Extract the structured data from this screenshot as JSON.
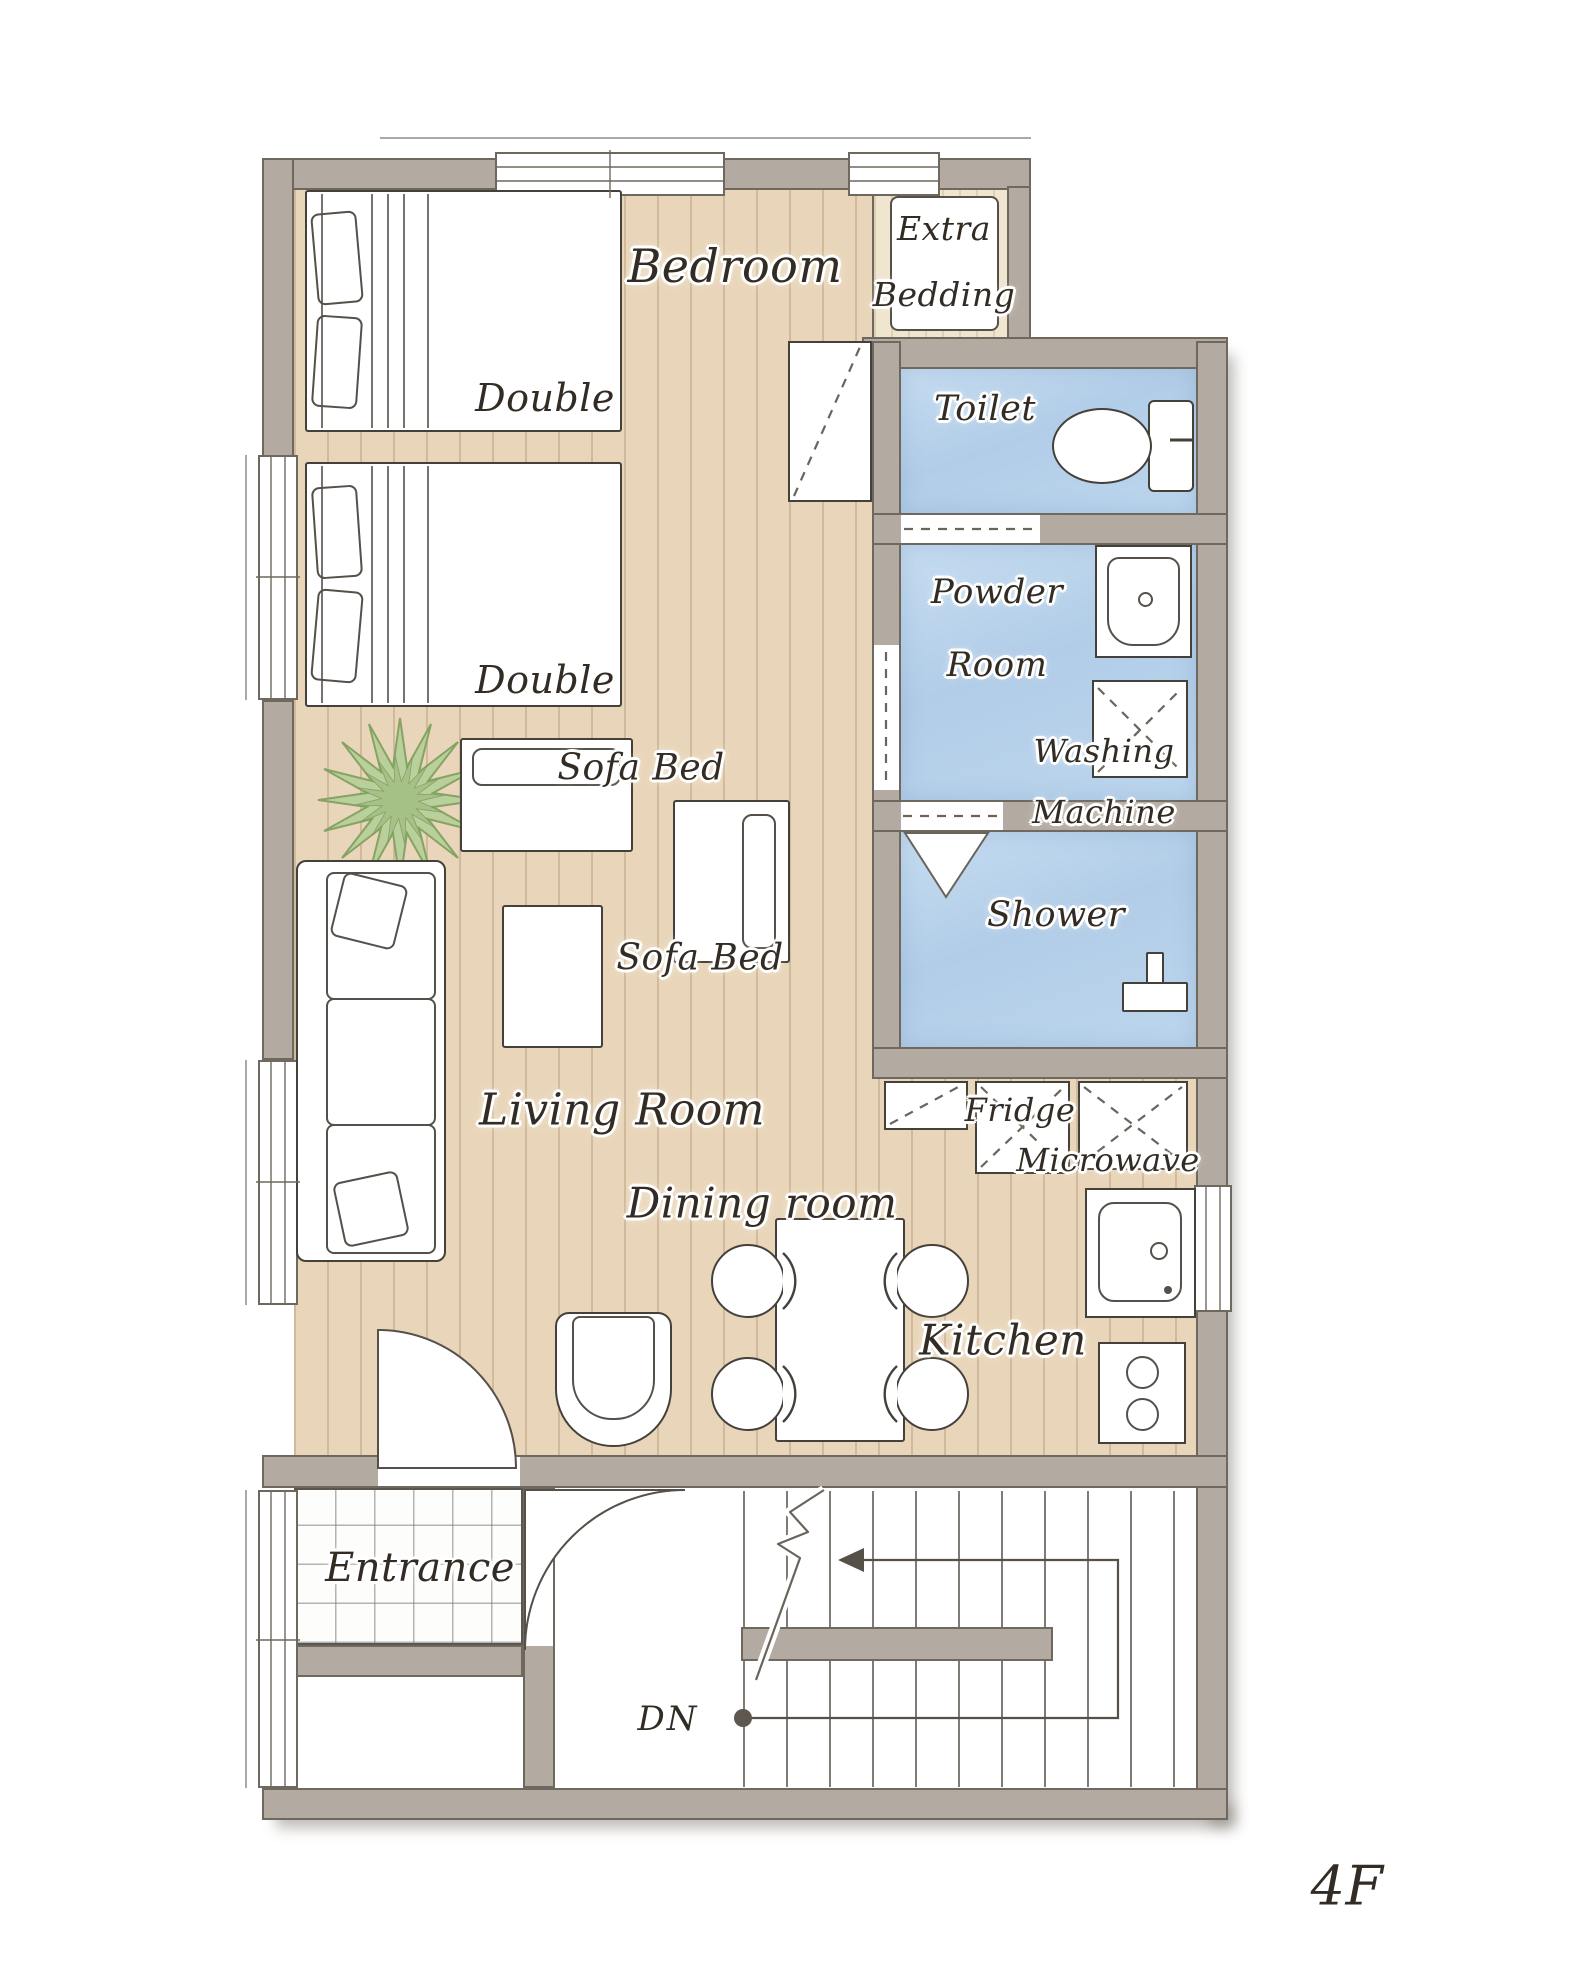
{
  "floor_indicator": "4F",
  "labels": {
    "bedroom": "Bedroom",
    "extra_bedding": [
      "Extra",
      "Bedding"
    ],
    "double_top": "Double",
    "double_bottom": "Double",
    "toilet": "Toilet",
    "powder_room": [
      "Powder",
      "Room"
    ],
    "washing_machine": [
      "Washing",
      "Machine"
    ],
    "shower": "Shower",
    "sofa_bed_top": "Sofa Bed",
    "sofa_bed_right": "Sofa Bed",
    "living_room": "Living Room",
    "dining_room": "Dining room",
    "fridge": "Fridge",
    "microwave": "Microwave",
    "kitchen": "Kitchen",
    "entrance": "Entrance",
    "stairs_down": "DN"
  },
  "colors": {
    "wall": "#b3aaa1",
    "wood_floor": "#e9d6ba",
    "closet_floor": "#f0e5cf",
    "wet_room_floor": "#b7d1e9",
    "plant_green": "#b9d09c",
    "ink": "#322c24"
  }
}
